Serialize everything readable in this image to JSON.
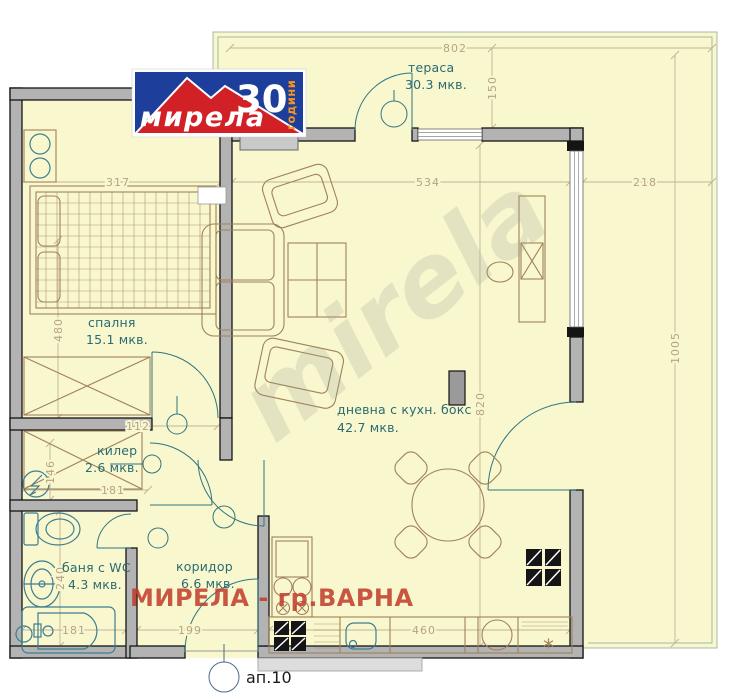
{
  "plan": {
    "rooms": [
      {
        "name": "тераса",
        "area": "30.3 мкв."
      },
      {
        "name": "спалня",
        "area": "15.1 мкв."
      },
      {
        "name": "дневна с кухн. бокс",
        "area": "42.7 мкв."
      },
      {
        "name": "килер",
        "area": "2.6 мкв."
      },
      {
        "name": "баня с WC",
        "area": "4.3 мкв."
      },
      {
        "name": "коридор",
        "area": "6.6 мкв."
      }
    ],
    "dimensions": {
      "top_total": "802",
      "terrace_depth": "150",
      "bedroom_width": "317",
      "living_width": "534",
      "terrace_side_width": "218",
      "bedroom_height": "480",
      "terrace_side_length": "1005",
      "living_height": "820",
      "hall_width": "112",
      "kiler_height": "146",
      "kiler_width": "181",
      "bath_height": "240",
      "bath_width": "181",
      "corridor_width": "199",
      "kitchen_width": "460"
    },
    "apartment_label": "ап.10",
    "kitchen_note": "*"
  },
  "logo": {
    "brand": "мирела",
    "number": "30",
    "suffix": "години"
  },
  "watermark": {
    "diagonal": "mirela",
    "banner": "МИРЕЛА - гр.ВАРНА"
  },
  "colors": {
    "floor": "#f9f7cd",
    "wall": "#b3b3b3",
    "label": "#2a6b74",
    "dimension": "#b5a385",
    "furniture": "#a0815a",
    "plumbing": "#3d7d92",
    "logo_blue": "#1d3e9a",
    "logo_red": "#d22027",
    "logo_orange": "#f7941d",
    "watermark_red": "#c13a2c"
  }
}
